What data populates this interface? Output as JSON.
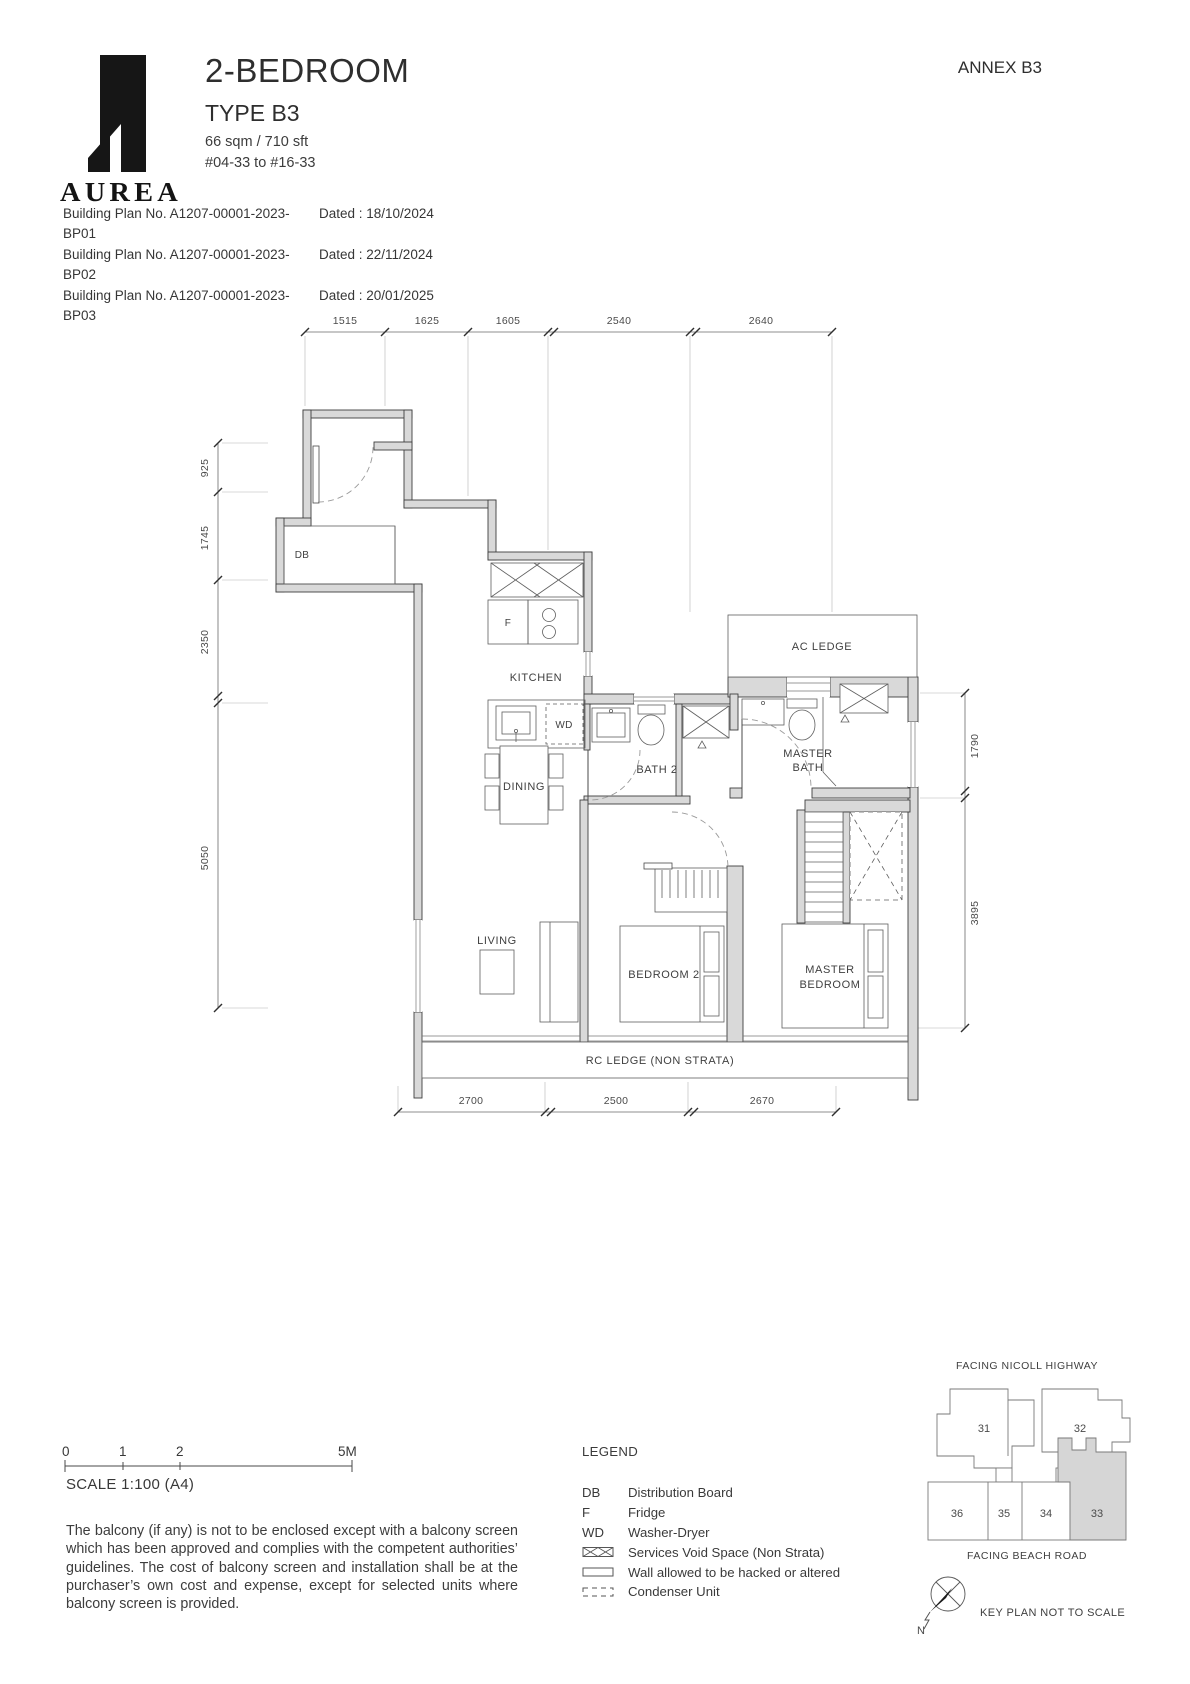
{
  "header": {
    "brand": "AUREA",
    "title": "2-BEDROOM",
    "type": "TYPE B3",
    "area": "66 sqm / 710 sft",
    "stack": "#04-33 to #16-33",
    "annex": "ANNEX B3",
    "building_plans": [
      {
        "no": "Building Plan No. A1207-00001-2023-BP01",
        "dated": "Dated : 18/10/2024"
      },
      {
        "no": "Building Plan No. A1207-00001-2023-BP02",
        "dated": "Dated : 22/11/2024"
      },
      {
        "no": "Building Plan No. A1207-00001-2023-BP03",
        "dated": "Dated : 20/01/2025"
      }
    ]
  },
  "plan": {
    "rooms": {
      "kitchen": "KITCHEN",
      "dining": "DINING",
      "living": "LIVING",
      "bath2": "BATH 2",
      "master_bath_l1": "MASTER",
      "master_bath_l2": "BATH",
      "bedroom2": "BEDROOM 2",
      "master_bedroom_l1": "MASTER",
      "master_bedroom_l2": "BEDROOM",
      "ac_ledge": "AC LEDGE",
      "rc_ledge": "RC LEDGE (NON STRATA)",
      "db": "DB",
      "fridge": "F",
      "washer_dryer": "WD"
    },
    "dims": {
      "top": [
        "1515",
        "1625",
        "1605",
        "2540",
        "2640"
      ],
      "left": [
        "925",
        "1745",
        "2350",
        "5050"
      ],
      "right": [
        "1790",
        "3895"
      ],
      "bottom": [
        "2700",
        "2500",
        "2670"
      ]
    }
  },
  "scale_bar": {
    "t0": "0",
    "t1": "1",
    "t2": "2",
    "t3": "5M",
    "label": "SCALE 1:100 (A4)"
  },
  "disclaimer": "The balcony (if any) is not to be enclosed except with a balcony screen which has been approved and complies with the competent authorities’ guidelines. The cost of balcony screen and installation shall be at the purchaser’s own cost and expense, except for selected units where balcony screen is provided.",
  "legend": {
    "title": "LEGEND",
    "items": [
      {
        "key": "DB",
        "label": "Distribution Board"
      },
      {
        "key": "F",
        "label": "Fridge"
      },
      {
        "key": "WD",
        "label": "Washer-Dryer"
      },
      {
        "key": "",
        "label": "Services Void Space (Non Strata)"
      },
      {
        "key": "",
        "label": "Wall allowed to be hacked or altered"
      },
      {
        "key": "",
        "label": "Condenser Unit"
      }
    ]
  },
  "key_plan": {
    "facing_top": "FACING NICOLL HIGHWAY",
    "facing_bottom": "FACING BEACH ROAD",
    "units": [
      "31",
      "32",
      "36",
      "35",
      "34",
      "33"
    ],
    "highlighted_unit": "33",
    "note": "KEY PLAN NOT TO SCALE",
    "north": "N"
  }
}
